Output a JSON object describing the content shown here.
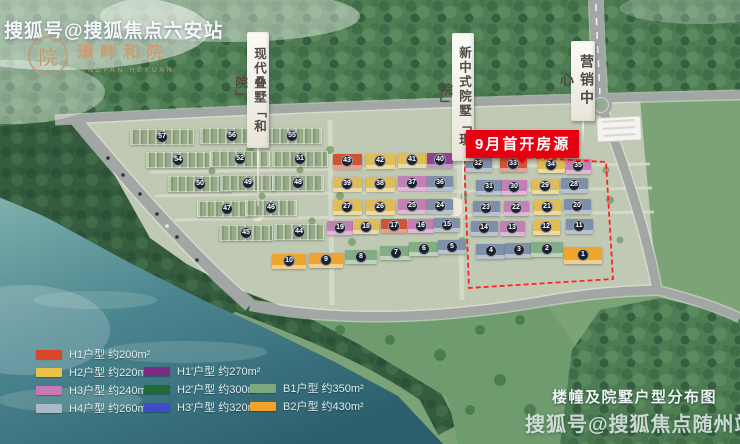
{
  "watermark_top": "搜狐号@搜狐焦点六安站",
  "watermark_bottom": "搜狐号@搜狐焦点随州站",
  "logo": {
    "name": "璟畔和院",
    "subtitle": "JINGPAN HEYUAN",
    "seal": "院"
  },
  "banners": [
    {
      "label": "现代叠墅「和院」"
    },
    {
      "label": "新中式院墅「璟院」"
    },
    {
      "label": "营销中心"
    }
  ],
  "badge": {
    "label": "9月首开房源",
    "color": "#e60012"
  },
  "map_title": "楼幢及院墅户型分布图",
  "legend": {
    "columns": [
      {
        "items": [
          {
            "text": "H1户型 约200m²",
            "color": "#d9472b"
          },
          {
            "text": "H2户型 约220m²",
            "color": "#e8c34a"
          },
          {
            "text": "H3户型 约240m²",
            "color": "#c778b5"
          },
          {
            "text": "H4户型 约260m²",
            "color": "#a9bac8"
          }
        ]
      },
      {
        "items": [
          {
            "text": "H1'户型 约270m²",
            "color": "#7b2d82"
          },
          {
            "text": "H2'户型 约300m²",
            "color": "#1e6b34"
          },
          {
            "text": "H3'户型 约320m²",
            "color": "#3f4bc8"
          }
        ]
      },
      {
        "items": [
          {
            "text": "B1户型 约350m²",
            "color": "#7dab7f"
          },
          {
            "text": "B2户型 约430m²",
            "color": "#f0a42c"
          }
        ]
      }
    ]
  },
  "building_colors": {
    "lv": "#96ab86",
    "y": "#dfbc55",
    "r": "#cf5436",
    "p": "#c47fb4",
    "pu": "#8f4492",
    "bl": "#7e90a9",
    "b1": "#83ad84",
    "b2": "#efa42e"
  },
  "buildings": [
    {
      "n": 57,
      "x": 161,
      "y": 136,
      "w": 62,
      "h": 14,
      "t": "lv"
    },
    {
      "n": 56,
      "x": 231,
      "y": 135,
      "w": 62,
      "h": 14,
      "t": "lv"
    },
    {
      "n": 55,
      "x": 291,
      "y": 135,
      "w": 58,
      "h": 14,
      "t": "lv"
    },
    {
      "n": 54,
      "x": 177,
      "y": 159,
      "w": 62,
      "h": 14,
      "t": "lv"
    },
    {
      "n": 52,
      "x": 239,
      "y": 158,
      "w": 58,
      "h": 14,
      "t": "lv"
    },
    {
      "n": 51,
      "x": 299,
      "y": 158,
      "w": 54,
      "h": 14,
      "t": "lv"
    },
    {
      "n": 50,
      "x": 199,
      "y": 183,
      "w": 62,
      "h": 14,
      "t": "lv"
    },
    {
      "n": 49,
      "x": 247,
      "y": 182,
      "w": 54,
      "h": 14,
      "t": "lv"
    },
    {
      "n": 48,
      "x": 297,
      "y": 182,
      "w": 50,
      "h": 14,
      "t": "lv"
    },
    {
      "n": 47,
      "x": 226,
      "y": 208,
      "w": 58,
      "h": 14,
      "t": "lv"
    },
    {
      "n": 46,
      "x": 270,
      "y": 207,
      "w": 50,
      "h": 14,
      "t": "lv"
    },
    {
      "n": 45,
      "x": 245,
      "y": 232,
      "w": 52,
      "h": 14,
      "t": "lv"
    },
    {
      "n": 44,
      "x": 298,
      "y": 231,
      "w": 48,
      "h": 14,
      "t": "lv"
    },
    {
      "n": 43,
      "x": 347,
      "y": 161,
      "w": 29,
      "h": 15,
      "t": "r"
    },
    {
      "n": 42,
      "x": 380,
      "y": 161,
      "w": 29,
      "h": 15,
      "t": "y"
    },
    {
      "n": 41,
      "x": 412,
      "y": 160,
      "w": 29,
      "h": 15,
      "t": "y"
    },
    {
      "n": 40,
      "x": 440,
      "y": 160,
      "w": 26,
      "h": 15,
      "t": "pu"
    },
    {
      "n": 39,
      "x": 347,
      "y": 184,
      "w": 29,
      "h": 15,
      "t": "y"
    },
    {
      "n": 38,
      "x": 380,
      "y": 184,
      "w": 29,
      "h": 15,
      "t": "y"
    },
    {
      "n": 37,
      "x": 412,
      "y": 183,
      "w": 29,
      "h": 15,
      "t": "p"
    },
    {
      "n": 36,
      "x": 440,
      "y": 183,
      "w": 26,
      "h": 15,
      "t": "bl"
    },
    {
      "n": 27,
      "x": 347,
      "y": 207,
      "w": 29,
      "h": 15,
      "t": "y"
    },
    {
      "n": 26,
      "x": 380,
      "y": 207,
      "w": 29,
      "h": 15,
      "t": "y"
    },
    {
      "n": 25,
      "x": 412,
      "y": 206,
      "w": 29,
      "h": 15,
      "t": "p"
    },
    {
      "n": 24,
      "x": 440,
      "y": 206,
      "w": 26,
      "h": 15,
      "t": "bl"
    },
    {
      "n": 19,
      "x": 340,
      "y": 228,
      "w": 26,
      "h": 14,
      "t": "p"
    },
    {
      "n": 18,
      "x": 366,
      "y": 227,
      "w": 26,
      "h": 14,
      "t": "y"
    },
    {
      "n": 17,
      "x": 394,
      "y": 226,
      "w": 26,
      "h": 14,
      "t": "r"
    },
    {
      "n": 16,
      "x": 421,
      "y": 226,
      "w": 26,
      "h": 14,
      "t": "p"
    },
    {
      "n": 15,
      "x": 447,
      "y": 225,
      "w": 26,
      "h": 14,
      "t": "bl"
    },
    {
      "n": 10,
      "x": 289,
      "y": 261,
      "w": 34,
      "h": 15,
      "t": "b2"
    },
    {
      "n": 9,
      "x": 326,
      "y": 260,
      "w": 34,
      "h": 15,
      "t": "b2"
    },
    {
      "n": 8,
      "x": 361,
      "y": 257,
      "w": 32,
      "h": 14,
      "t": "b1"
    },
    {
      "n": 7,
      "x": 396,
      "y": 253,
      "w": 32,
      "h": 14,
      "t": "b1"
    },
    {
      "n": 6,
      "x": 424,
      "y": 249,
      "w": 30,
      "h": 14,
      "t": "b1"
    },
    {
      "n": 5,
      "x": 452,
      "y": 247,
      "w": 28,
      "h": 14,
      "t": "bl"
    },
    {
      "n": 32,
      "x": 478,
      "y": 164,
      "w": 27,
      "h": 15,
      "t": "bl"
    },
    {
      "n": 33,
      "x": 513,
      "y": 164,
      "w": 27,
      "h": 15,
      "t": "r"
    },
    {
      "n": 34,
      "x": 551,
      "y": 165,
      "w": 27,
      "h": 15,
      "t": "y"
    },
    {
      "n": 35,
      "x": 578,
      "y": 166,
      "w": 25,
      "h": 15,
      "t": "p"
    },
    {
      "n": 31,
      "x": 489,
      "y": 187,
      "w": 27,
      "h": 15,
      "t": "bl"
    },
    {
      "n": 30,
      "x": 514,
      "y": 187,
      "w": 25,
      "h": 15,
      "t": "p"
    },
    {
      "n": 29,
      "x": 545,
      "y": 186,
      "w": 27,
      "h": 15,
      "t": "y"
    },
    {
      "n": 28,
      "x": 574,
      "y": 185,
      "w": 27,
      "h": 15,
      "t": "bl"
    },
    {
      "n": 23,
      "x": 486,
      "y": 208,
      "w": 27,
      "h": 15,
      "t": "bl"
    },
    {
      "n": 22,
      "x": 516,
      "y": 208,
      "w": 25,
      "h": 15,
      "t": "p"
    },
    {
      "n": 21,
      "x": 547,
      "y": 207,
      "w": 27,
      "h": 15,
      "t": "y"
    },
    {
      "n": 20,
      "x": 577,
      "y": 206,
      "w": 27,
      "h": 15,
      "t": "bl"
    },
    {
      "n": 14,
      "x": 484,
      "y": 228,
      "w": 27,
      "h": 15,
      "t": "bl"
    },
    {
      "n": 13,
      "x": 512,
      "y": 228,
      "w": 25,
      "h": 15,
      "t": "p"
    },
    {
      "n": 12,
      "x": 546,
      "y": 227,
      "w": 27,
      "h": 15,
      "t": "y"
    },
    {
      "n": 11,
      "x": 579,
      "y": 226,
      "w": 27,
      "h": 15,
      "t": "bl"
    },
    {
      "n": 4,
      "x": 491,
      "y": 251,
      "w": 30,
      "h": 15,
      "t": "bl"
    },
    {
      "n": 3,
      "x": 519,
      "y": 250,
      "w": 28,
      "h": 15,
      "t": "bl"
    },
    {
      "n": 2,
      "x": 547,
      "y": 249,
      "w": 32,
      "h": 15,
      "t": "b1"
    },
    {
      "n": 1,
      "x": 583,
      "y": 255,
      "w": 38,
      "h": 17,
      "t": "b2"
    }
  ]
}
